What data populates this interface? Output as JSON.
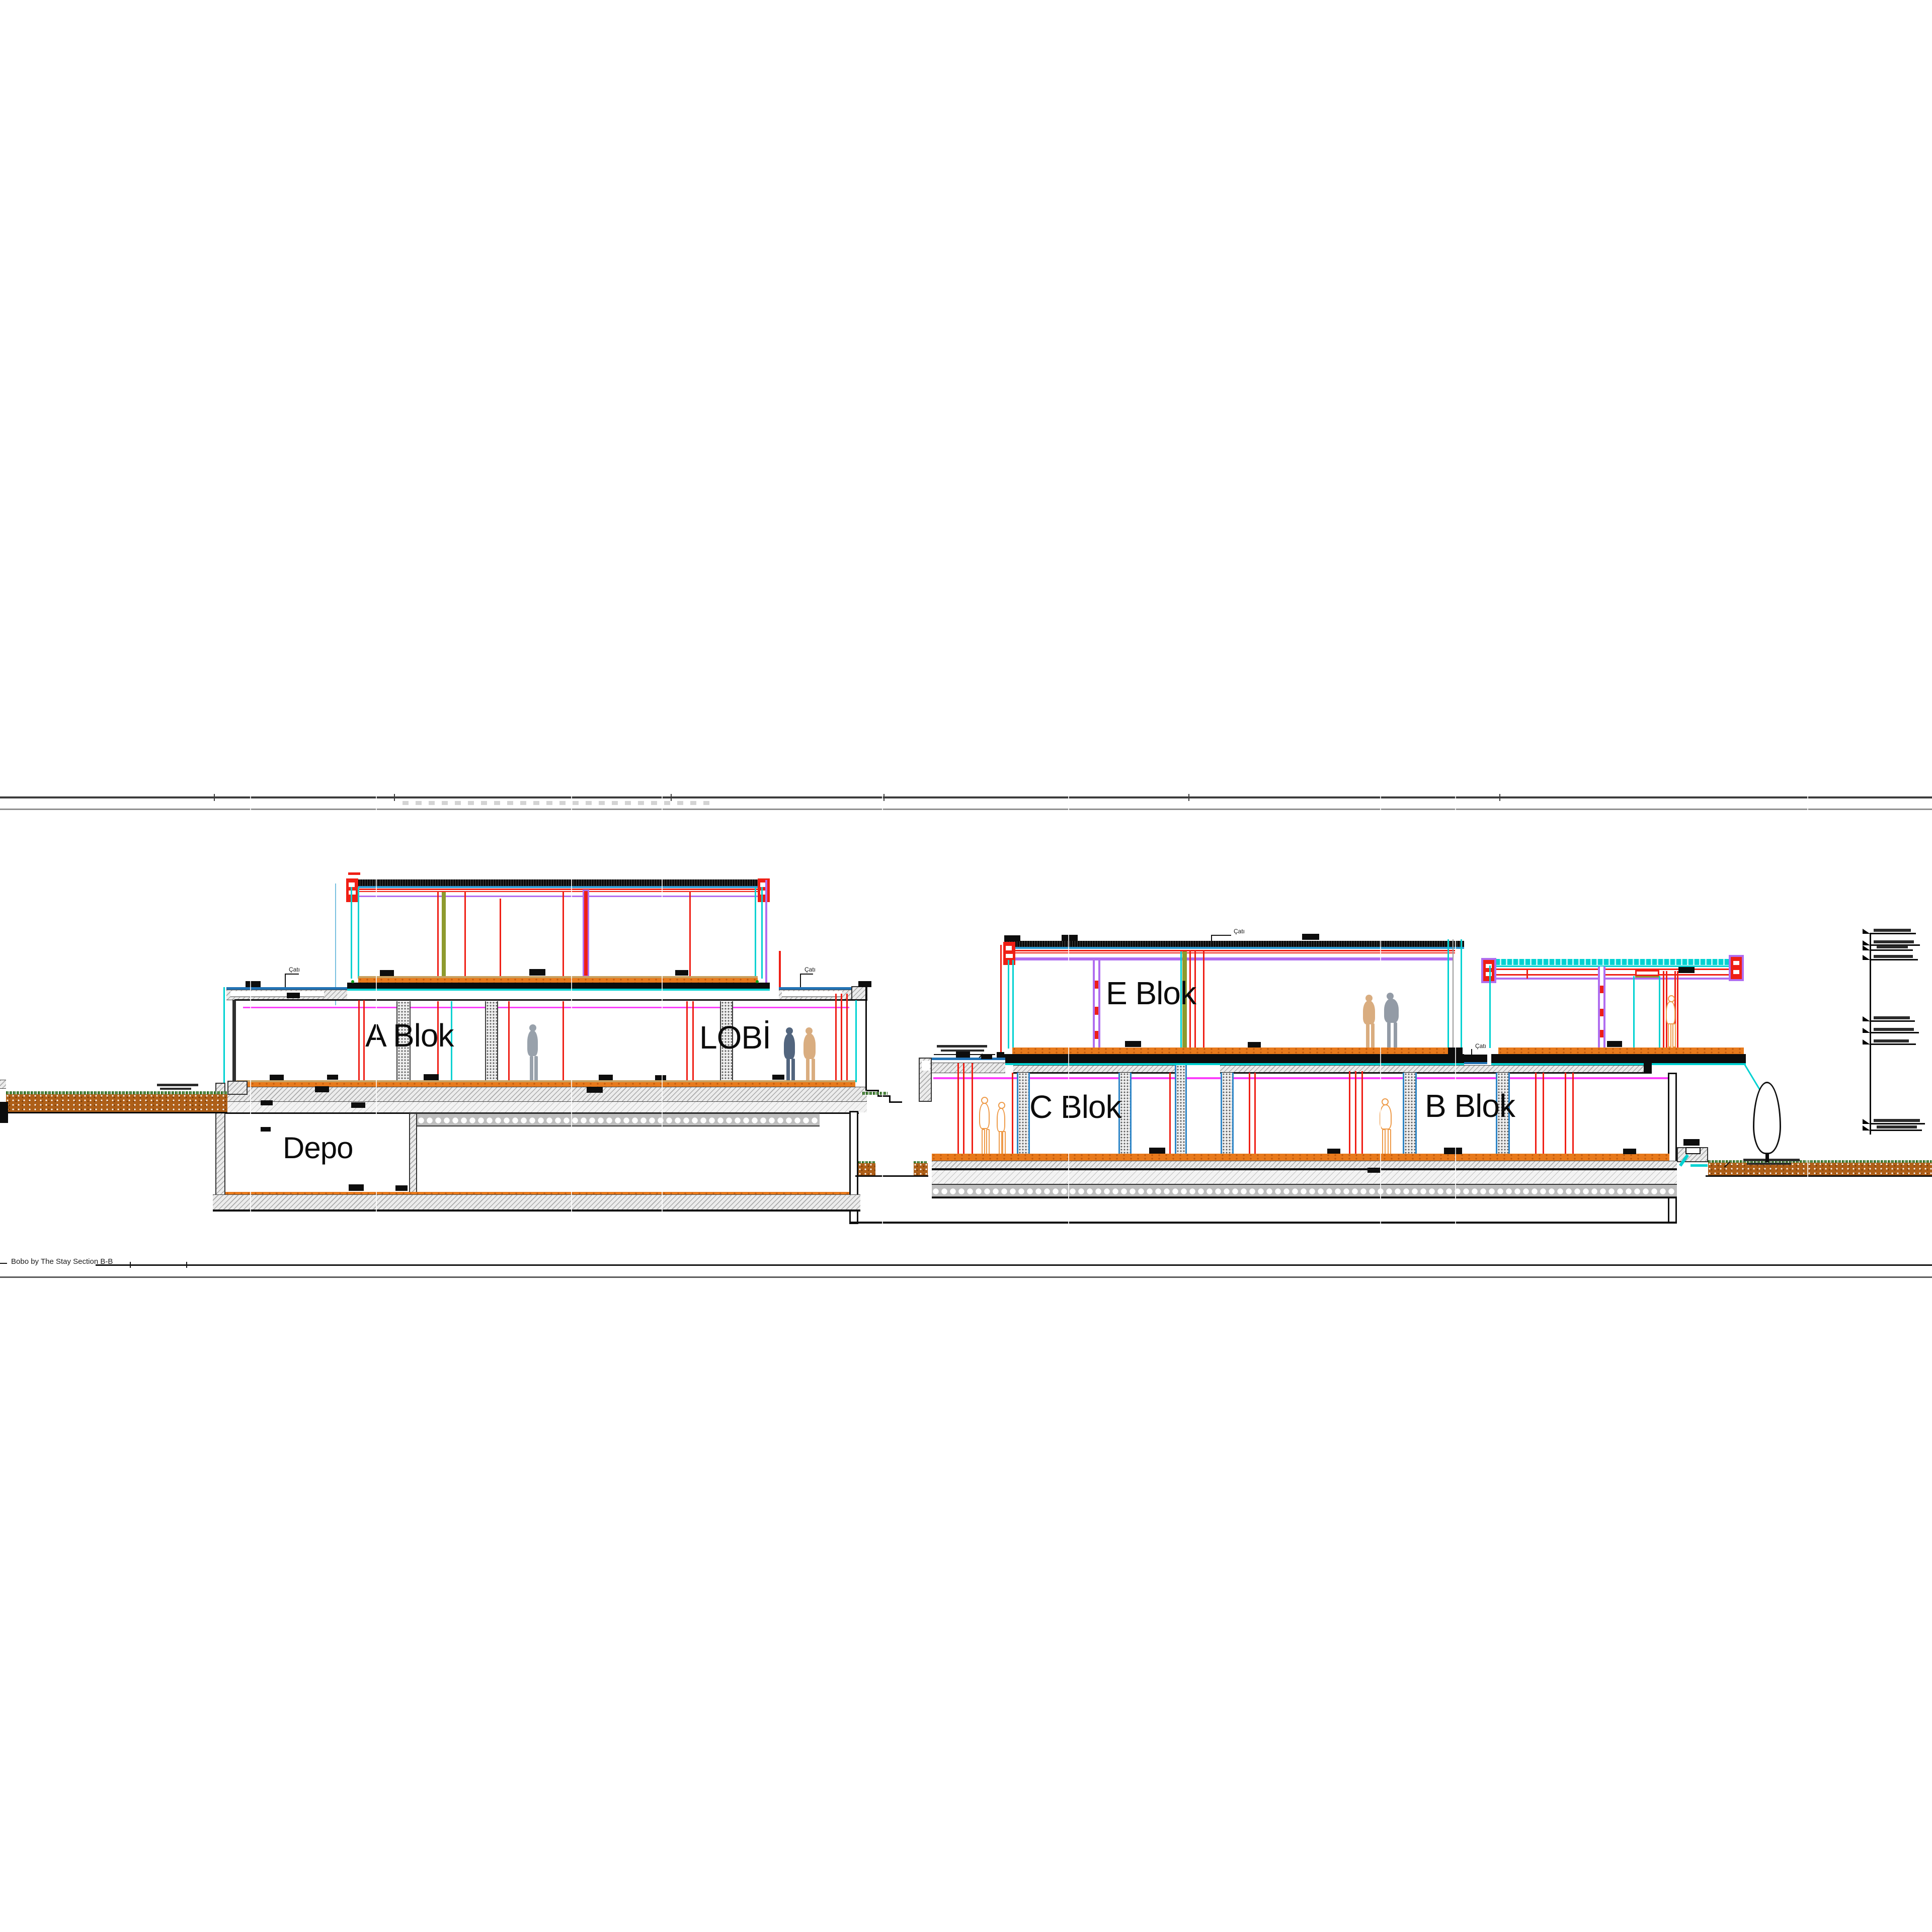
{
  "page": {
    "background": "#ffffff"
  },
  "drawing": {
    "footer_label": "Bobo by The Stay Section B-B",
    "rooms": {
      "a_blok": "A Blok",
      "lobi": "LOBİ",
      "depo": "Depo",
      "e_blok": "E Blok",
      "c_blok": "C Blok",
      "b_blok": "B Blok"
    },
    "annotations": {
      "cati": "Çatı"
    },
    "colors": {
      "section_red": "#ef1f15",
      "glass_cyan": "#00d2d2",
      "steel_blue": "#2273b5",
      "insulation_magenta": "#fb3ffb",
      "frame_purple": "#b06ef0",
      "floor_orange": "#e87a1c",
      "soil_brown": "#ae5f18",
      "olive_column": "#8e9a2e",
      "grass_green": "#225c18",
      "slab_gray": "#ececec"
    }
  }
}
